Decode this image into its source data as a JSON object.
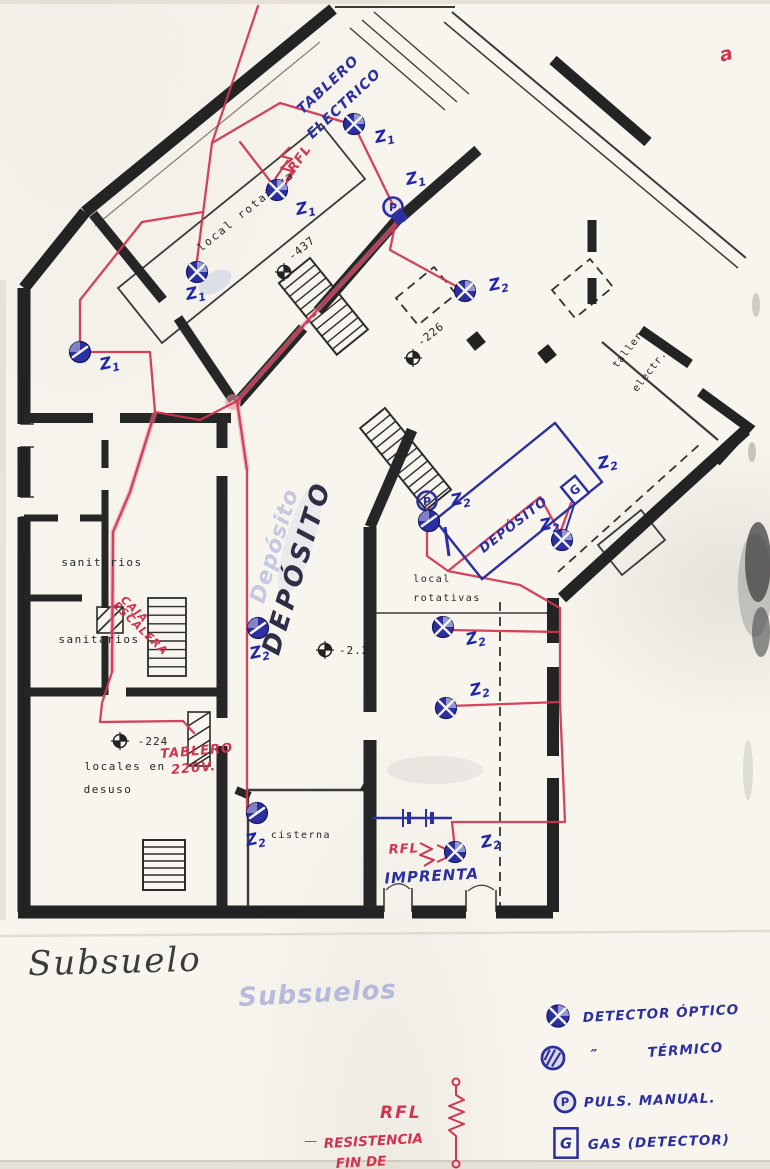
{
  "palette": {
    "paper": "#f8f5ef",
    "ink_black": "#262626",
    "ink_blue": "#2b2f9f",
    "zone_blue": "#1f26a8",
    "ink_red": "#d1344f",
    "ink_pink": "#ec8fa4",
    "pencil": "#3b3b3b",
    "ghost_blue": "#7b86cc"
  },
  "pencil_title": {
    "text": "Subsuelo"
  },
  "labels_printed": [
    {
      "name": "room-local-rotativa",
      "text": "local rotativa",
      "x": 248,
      "y": 214,
      "rot": -39,
      "size": 11,
      "ls": 2
    },
    {
      "name": "room-taller",
      "text": "taller",
      "x": 630,
      "y": 352,
      "rot": -52,
      "size": 10,
      "ls": 1
    },
    {
      "name": "room-taller-electr",
      "text": "electr.",
      "x": 652,
      "y": 373,
      "rot": -52,
      "size": 10,
      "ls": 1
    },
    {
      "name": "room-sanitarios-1",
      "text": "sanitarios",
      "x": 102,
      "y": 566,
      "rot": 0,
      "size": 11,
      "ls": 1.5
    },
    {
      "name": "room-sanitarios-2",
      "text": "sanitarios",
      "x": 99,
      "y": 643,
      "rot": 0,
      "size": 11,
      "ls": 1.5
    },
    {
      "name": "room-locales-en",
      "text": "locales en",
      "x": 125,
      "y": 770,
      "rot": 0,
      "size": 11,
      "ls": 1.5
    },
    {
      "name": "room-desuso",
      "text": "desuso",
      "x": 108,
      "y": 793,
      "rot": 0,
      "size": 11,
      "ls": 1.5
    },
    {
      "name": "room-cisterna",
      "text": "cisterna",
      "x": 301,
      "y": 838,
      "rot": 0,
      "size": 10,
      "ls": 1.5
    },
    {
      "name": "room-local",
      "text": "local",
      "x": 432,
      "y": 582,
      "rot": 0,
      "size": 10,
      "ls": 1.5
    },
    {
      "name": "room-rotativas",
      "text": "rotativas",
      "x": 447,
      "y": 601,
      "rot": 0,
      "size": 10,
      "ls": 1.5
    }
  ],
  "level_marks": [
    {
      "name": "level-437",
      "text": "-437",
      "x": 284,
      "y": 272,
      "tx": 304,
      "ty": 251,
      "rot": -39
    },
    {
      "name": "level-226",
      "text": "-226",
      "x": 413,
      "y": 358,
      "tx": 433,
      "ty": 337,
      "rot": -39
    },
    {
      "name": "level-224",
      "text": "-224",
      "x": 120,
      "y": 741,
      "tx": 153,
      "ty": 745,
      "rot": 0
    },
    {
      "name": "level-221",
      "text": "-2.21",
      "x": 325,
      "y": 650,
      "tx": 358,
      "ty": 654,
      "rot": 0
    }
  ],
  "handwritten_blue": [
    {
      "name": "note-tablero",
      "text": "TABLERO",
      "x": 331,
      "y": 88,
      "rot": -43,
      "size": 14
    },
    {
      "name": "note-electrico",
      "text": "ELECTRICO",
      "x": 347,
      "y": 107,
      "rot": -43,
      "size": 14
    },
    {
      "name": "note-deposito-ghost",
      "text": "Depósito",
      "x": 281,
      "y": 548,
      "rot": -73,
      "size": 22,
      "color": "#7b86cc",
      "opacity": 0.4
    },
    {
      "name": "note-deposito-big",
      "text": "DEPÓSITO",
      "x": 305,
      "y": 570,
      "rot": -73,
      "size": 26,
      "color": "#2e2e45",
      "ls": 4
    },
    {
      "name": "note-deposito-room",
      "text": "DEPÓSITO",
      "x": 516,
      "y": 528,
      "rot": -38,
      "size": 13
    },
    {
      "name": "note-imprenta",
      "text": "IMPRENTA",
      "x": 432,
      "y": 881,
      "rot": -3,
      "size": 15
    },
    {
      "name": "note-subsuelos",
      "text": "Subsuelos",
      "x": 318,
      "y": 1002,
      "rot": -3,
      "size": 26,
      "color": "#7b86cc",
      "opacity": 0.5
    }
  ],
  "handwritten_red": [
    {
      "name": "note-rfl-top",
      "text": "RFL",
      "x": 303,
      "y": 161,
      "rot": -55,
      "size": 13
    },
    {
      "name": "note-caja",
      "text": "CAJA",
      "x": 132,
      "y": 612,
      "rot": 44,
      "size": 11
    },
    {
      "name": "note-escalera",
      "text": "ESCALERA",
      "x": 138,
      "y": 631,
      "rot": 44,
      "size": 11
    },
    {
      "name": "note-tablero-220-1",
      "text": "TABLERO",
      "x": 197,
      "y": 755,
      "rot": -5,
      "size": 13
    },
    {
      "name": "note-tablero-220-2",
      "text": "220V.",
      "x": 194,
      "y": 772,
      "rot": -5,
      "size": 13
    },
    {
      "name": "note-rfl-bottom",
      "text": "RFL",
      "x": 404,
      "y": 853,
      "rot": -3,
      "size": 13
    },
    {
      "name": "corner-mark",
      "text": "a",
      "x": 728,
      "y": 60,
      "rot": -15,
      "size": 19
    }
  ],
  "markers": [
    {
      "zone": "Z1",
      "type": "optical",
      "x": 277,
      "y": 190,
      "lx": 297,
      "ly": 215
    },
    {
      "zone": "Z1",
      "type": "optical",
      "x": 354,
      "y": 124,
      "lx": 376,
      "ly": 143
    },
    {
      "zone": "Z1",
      "type": "pulsador",
      "x": 393,
      "y": 207,
      "lx": 407,
      "ly": 185
    },
    {
      "zone": "Z1",
      "type": "optical",
      "x": 197,
      "y": 272,
      "lx": 187,
      "ly": 300
    },
    {
      "zone": "Z1",
      "type": "thermal",
      "x": 80,
      "y": 352,
      "lx": 101,
      "ly": 370
    },
    {
      "zone": "Z2",
      "type": "optical",
      "x": 465,
      "y": 291,
      "lx": 490,
      "ly": 291
    },
    {
      "zone": "Z2",
      "type": "pulsador",
      "x": 427,
      "y": 501,
      "lx": 452,
      "ly": 506
    },
    {
      "zone": "",
      "type": "thermal",
      "x": 429,
      "y": 521,
      "lx": 0,
      "ly": 0
    },
    {
      "zone": "Z2",
      "type": "gas",
      "x": 575,
      "y": 490,
      "lx": 599,
      "ly": 469
    },
    {
      "zone": "Z2",
      "type": "optical",
      "x": 562,
      "y": 540,
      "lx": 541,
      "ly": 531
    },
    {
      "zone": "Z2",
      "type": "thermal",
      "x": 258,
      "y": 628,
      "lx": 251,
      "ly": 659
    },
    {
      "zone": "Z2",
      "type": "optical",
      "x": 443,
      "y": 627,
      "lx": 467,
      "ly": 645
    },
    {
      "zone": "Z2",
      "type": "optical",
      "x": 446,
      "y": 708,
      "lx": 471,
      "ly": 696
    },
    {
      "zone": "Z2",
      "type": "thermal",
      "x": 257,
      "y": 813,
      "lx": 247,
      "ly": 846
    },
    {
      "zone": "Z2",
      "type": "optical",
      "x": 455,
      "y": 852,
      "lx": 482,
      "ly": 848
    }
  ],
  "legend": {
    "items": [
      {
        "name": "legend-detector-optico",
        "symbol": "optical",
        "sx": 558,
        "sy": 1016,
        "text": "DETECTOR ÓPTICO",
        "tx": 583,
        "ty": 1022,
        "rot": -3
      },
      {
        "name": "legend-detector-termico",
        "symbol": "thermal-outline",
        "sx": 553,
        "sy": 1058,
        "ditto": "″",
        "dx": 594,
        "dy": 1060,
        "text": "TÉRMICO",
        "tx": 648,
        "ty": 1057,
        "rot": -4
      },
      {
        "name": "legend-pulsador-manual",
        "symbol": "pulsador",
        "sx": 565,
        "sy": 1102,
        "text": "PULS. MANUAL.",
        "tx": 584,
        "ty": 1107,
        "rot": -2
      },
      {
        "name": "legend-gas-detector",
        "symbol": "gas-box",
        "sx": 566,
        "sy": 1143,
        "text": "GAS (DETECTOR)",
        "tx": 588,
        "ty": 1149,
        "rot": -2
      }
    ],
    "rfl": {
      "label": "RFL",
      "lx": 380,
      "ly": 1118,
      "dash": "—",
      "dx": 304,
      "dy": 1145,
      "note1": "RESISTENCIA",
      "n1x": 324,
      "n1y": 1148,
      "note2": "FIN DE",
      "n2x": 336,
      "n2y": 1168
    }
  }
}
